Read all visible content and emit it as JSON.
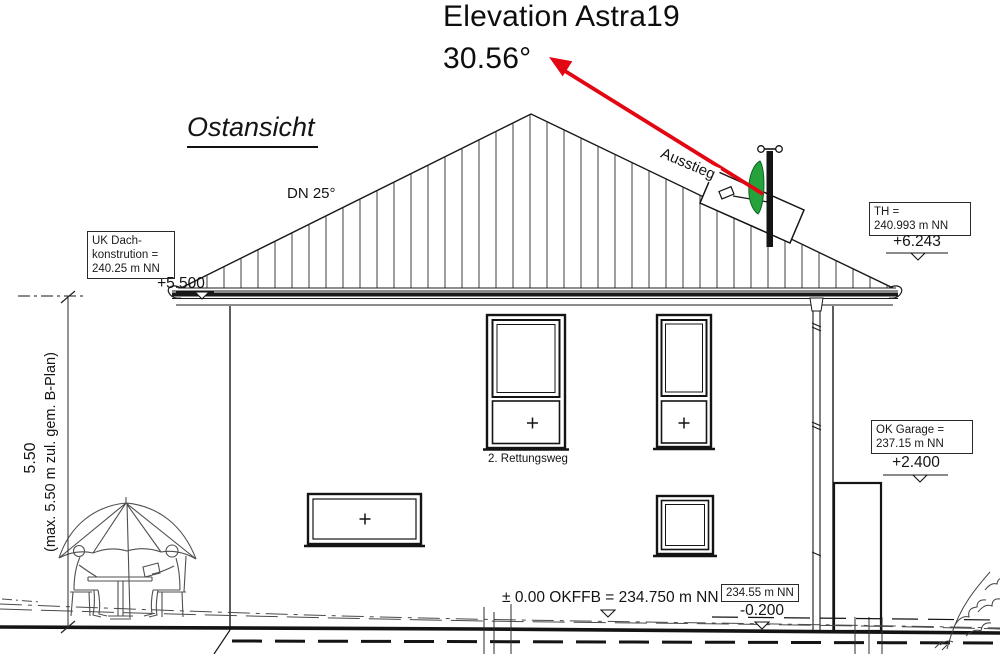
{
  "title": {
    "product": "Elevation Astra19",
    "angle": "30.56°"
  },
  "view": {
    "name": "Ostansicht",
    "roof_pitch": "DN 25°",
    "roof_exit": "Ausstieg",
    "rescue_route": "2. Rettungsweg"
  },
  "levels": {
    "uk_dach": {
      "line1": "UK Dach-",
      "line2": "konstrution =",
      "line3": "240.25 m NN",
      "value": "+5.500"
    },
    "th": {
      "line1": "TH =",
      "line2": "240.993 m NN",
      "value": "+6.243"
    },
    "ok_garage": {
      "line1": "OK Garage =",
      "line2": "237.15 m NN",
      "value": "+2.400"
    },
    "okffb": {
      "label": "± 0.00 OKFFB = 234.750 m NN"
    },
    "terrain": {
      "box": "234.55 m NN",
      "value": "-0.200"
    }
  },
  "dimension": {
    "value": "5.50",
    "note": "(max. 5.50 m zul. gem. B-Plan)"
  },
  "colors": {
    "arrow_red": "#e30613",
    "dish_green": "#25a23c",
    "ink": "#1a1a1a"
  }
}
